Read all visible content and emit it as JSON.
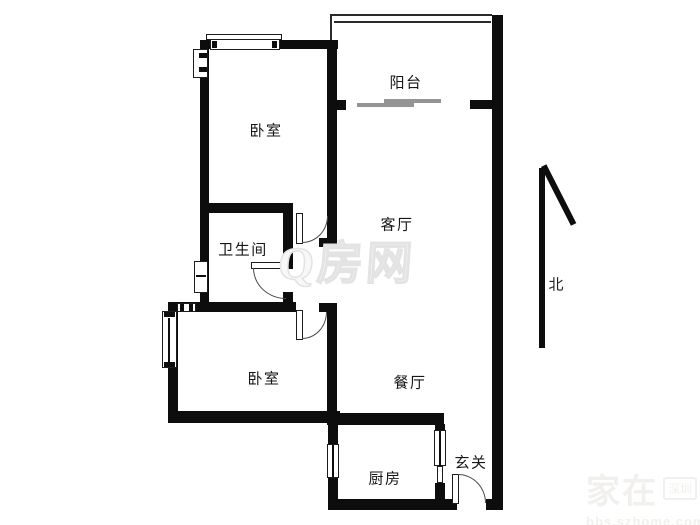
{
  "rooms": {
    "balcony": {
      "label": "阳台"
    },
    "bedroom_north": {
      "label": "卧室"
    },
    "living_room": {
      "label": "客厅"
    },
    "bathroom": {
      "label": "卫生间"
    },
    "bedroom_south": {
      "label": "卧室"
    },
    "dining_room": {
      "label": "餐厅"
    },
    "kitchen": {
      "label": "厨房"
    },
    "foyer": {
      "label": "玄关"
    }
  },
  "compass": {
    "north_label": "北"
  },
  "watermarks": {
    "center_logo": "Q房网",
    "corner_main": "家在",
    "corner_badge": "深圳",
    "corner_url": "bbs.szhome.com"
  },
  "colors": {
    "wall": "#0d0d0d",
    "sliding_door_rail": "#949494",
    "center_watermark": "#e3e3e3",
    "corner_watermark": "#f1f0ec"
  }
}
